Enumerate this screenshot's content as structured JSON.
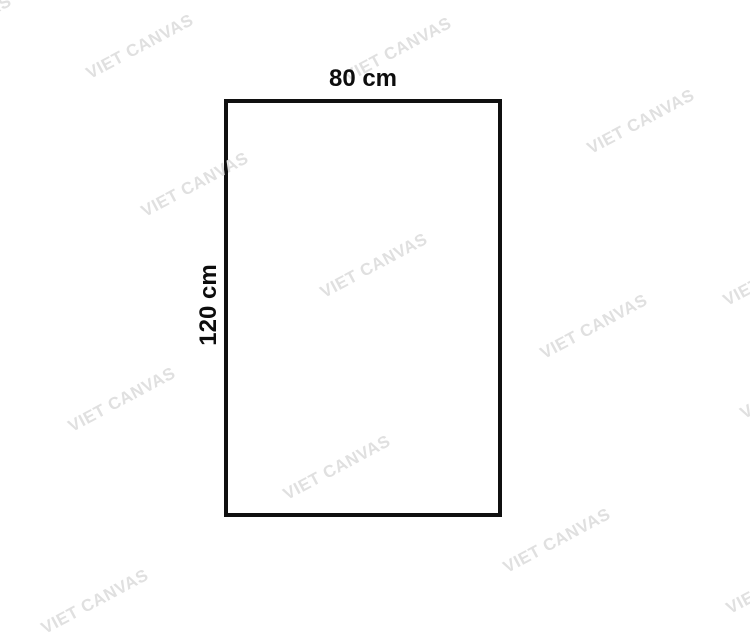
{
  "page": {
    "background_color": "#ffffff",
    "description": "Canvas print size diagram on white background"
  },
  "diagram": {
    "shape": "rectangle-outline",
    "width_label": "80 cm",
    "height_label": "120 cm",
    "border_color": "#101010",
    "label_color": "#0d0d0d"
  },
  "watermark": {
    "text": "VIET CANVAS",
    "color": "#e0e0e0",
    "angle_deg": -28,
    "positions": [
      {
        "x": -42,
        "y": 28
      },
      {
        "x": 140,
        "y": 47
      },
      {
        "x": 398,
        "y": 50
      },
      {
        "x": 641,
        "y": 122
      },
      {
        "x": 195,
        "y": 185
      },
      {
        "x": 374,
        "y": 266
      },
      {
        "x": 777,
        "y": 274
      },
      {
        "x": 594,
        "y": 327
      },
      {
        "x": 122,
        "y": 400
      },
      {
        "x": 794,
        "y": 387
      },
      {
        "x": 337,
        "y": 468
      },
      {
        "x": 557,
        "y": 541
      },
      {
        "x": 95,
        "y": 602
      },
      {
        "x": 780,
        "y": 582
      }
    ]
  }
}
